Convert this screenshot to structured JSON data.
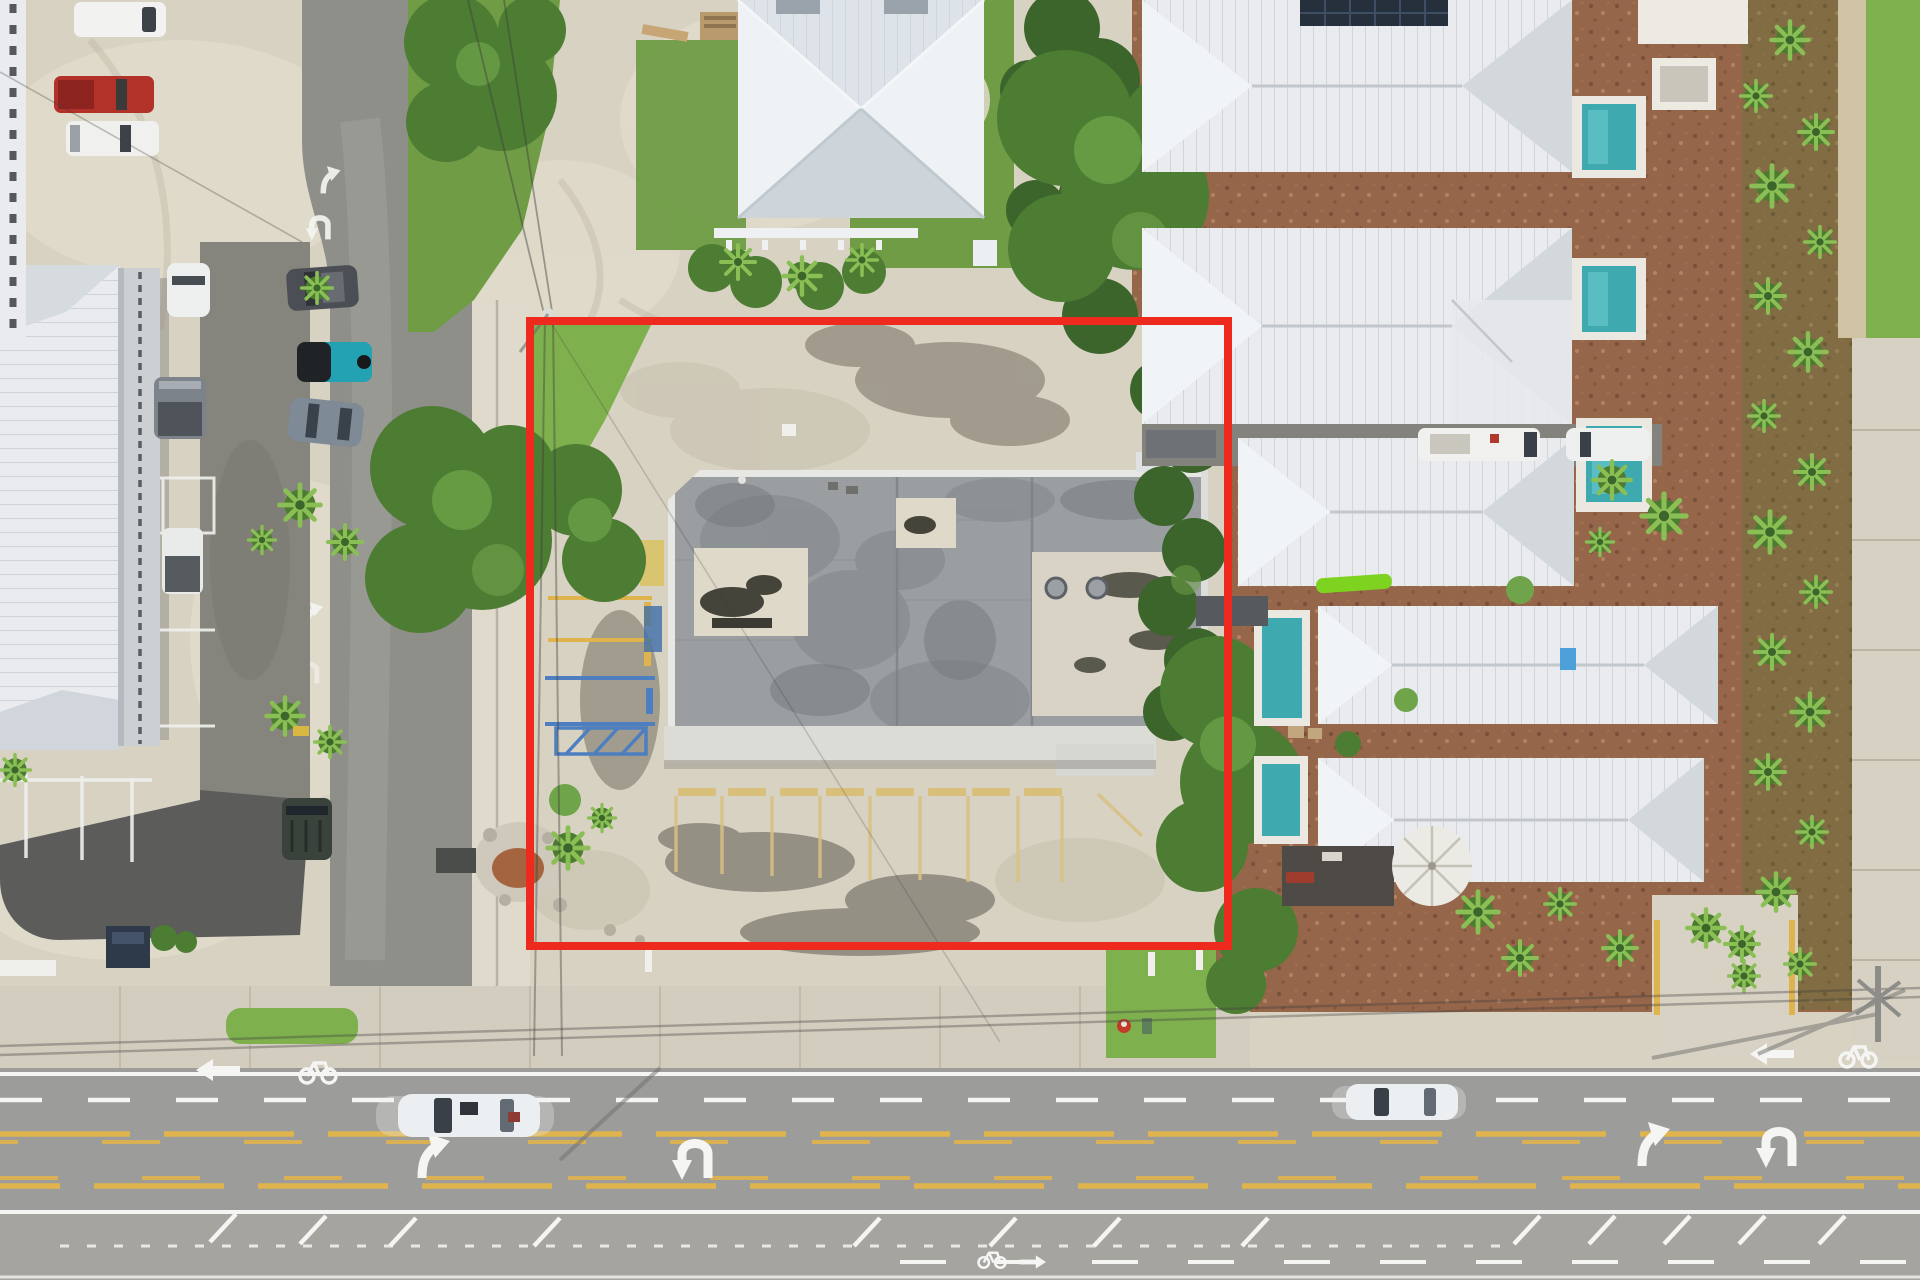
{
  "scene": {
    "description": "Aerial drone photograph of a commercial property parcel outlined with a red boundary rectangle, between a strip mall parking lot (left), a residential house (top), a row of white metal-roof townhouses with pools (right), and a multi-lane highway (bottom)",
    "visible_text": [],
    "annotation": {
      "label": "property-boundary",
      "shape": "rectangle",
      "color": "#ee2a1e",
      "stroke_width": 8,
      "x": 530,
      "y": 321,
      "width": 698,
      "height": 625
    },
    "inventory": {
      "subject_building": "flat gray roof with two white square patches, white membrane section, white front canopy",
      "parking_wheel_stops": 8,
      "townhouse_roof_rows": 5,
      "pools": 5,
      "highway_turn_arrows": 4,
      "bike_lane_symbols": 3,
      "moving_cars_on_highway": 2,
      "parked_vehicles_left_lot": 10,
      "fire_hydrant": 1,
      "solar_panel_roofs": 1
    }
  },
  "colors": {
    "sand": "#d8d2c2",
    "sandLight": "#e6e0d2",
    "sandShadow": "#c6bfae",
    "concrete": "#d3cdbf",
    "road": "#9c9c9a",
    "shoulder": "#b2b0a9",
    "drive": "#8f8f8a",
    "aisle": "#85847d",
    "asphaltDark": "#5c5d5b",
    "dirtLot": "#b4ad9e",
    "dirtDark": "#958e81",
    "grass": "#6f9c44",
    "grassBright": "#7fb04e",
    "hedge": "#3c652c",
    "tree": "#4d7c33",
    "treeLight": "#6fa44a",
    "palm": "#5d9038",
    "palmLight": "#8abf55",
    "mulch": "#96664a",
    "mulchDot": "#6f4833",
    "mulchDot2": "#b98a67",
    "roofWhite": "#e9ebee",
    "roofShade": "#ccd2d8",
    "roofLine": "#b9c0c7",
    "houseRoof": "#dde3e8",
    "bldgGray": "#9a9ea1",
    "bldgDark": "#84888c",
    "membrane": "#d8d3c4",
    "whitePatch": "#ded9c8",
    "stain": "#45443a",
    "parapet": "#e7e7e4",
    "canopy": "#dcdcd6",
    "pool": "#3fa9b0",
    "deck": "#eae8e1",
    "redLine": "#ee2a1e",
    "whitePaint": "#f5f5f3",
    "yellowPaint": "#e0b44d",
    "yellowPale": "#d9c184",
    "bluePaint": "#4d7fc0",
    "solar": "#26303d",
    "carRed": "#b23129",
    "carTeal": "#22a2b2",
    "carDark": "#43484e",
    "carGray": "#7e868e",
    "carBlue": "#7e8a96",
    "jeepDark": "#3a423c"
  }
}
